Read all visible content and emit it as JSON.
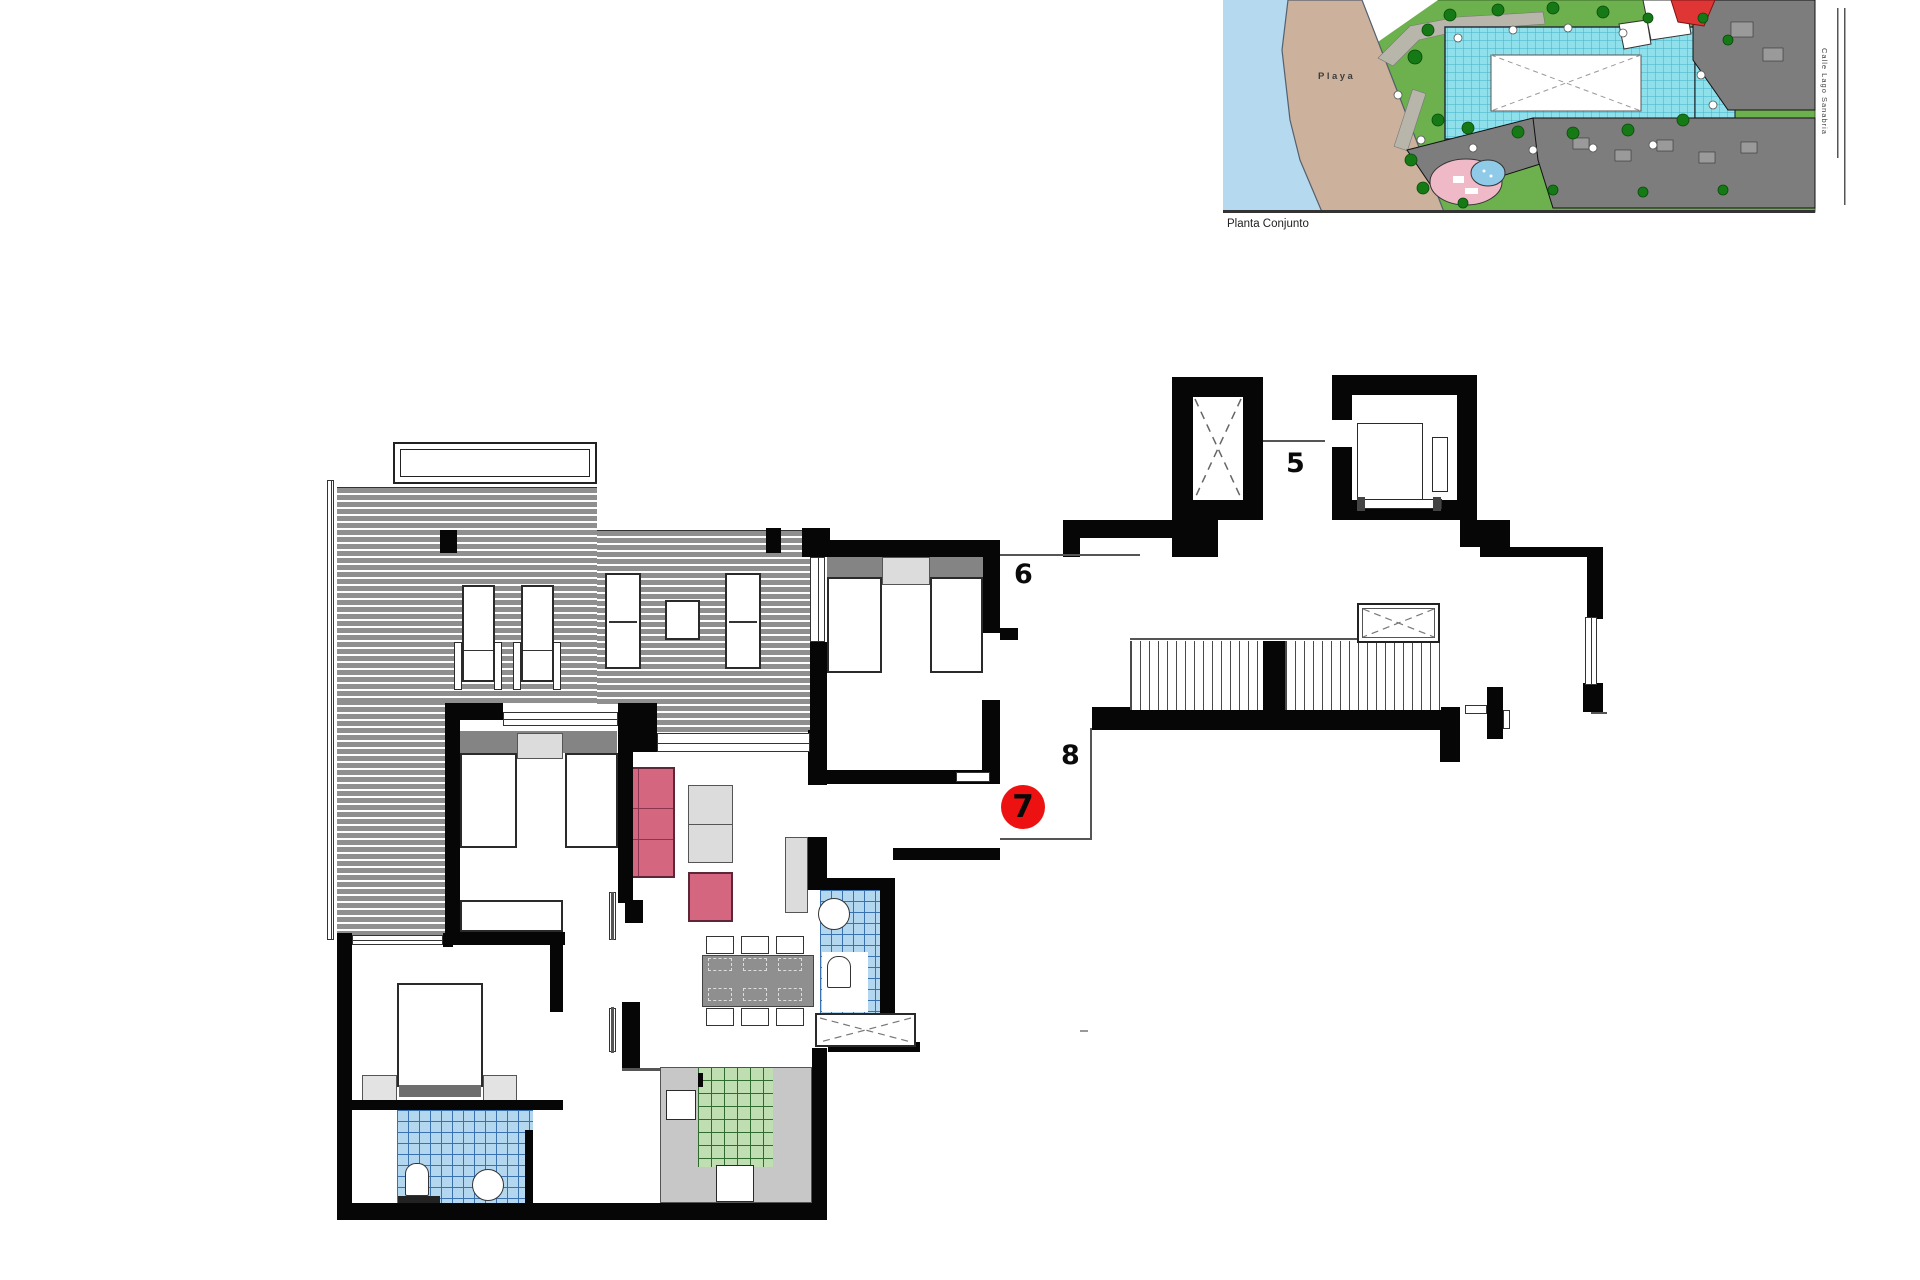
{
  "document": {
    "caption_site_plan": "Planta Conjunto"
  },
  "site_plan": {
    "beach_label": "Playa",
    "street_label": "Calle Lago Sanabria",
    "colors": {
      "water": "#b5daf0",
      "sand": "#ccb29c",
      "lawn": "#6cb14d",
      "pool": "#8fe0ea",
      "tree": "#157a15",
      "building": "#7d7d7d",
      "highlighted_building": "#e03535",
      "pond_pink": "#f0b9c8",
      "pond_blue": "#8fcbe8"
    }
  },
  "floor_plan": {
    "labels": {
      "unit_5": "5",
      "unit_6": "6",
      "unit_8": "8"
    },
    "highlighted_unit": {
      "number": "7",
      "marker_color": "#ee1111"
    },
    "colors": {
      "wall": "#060606",
      "terrace_deck": "#8f8f8f",
      "bathroom_tile": "#b3d7ee",
      "kitchen_tile": "#bfdfb2",
      "sofa": "#d4677f",
      "furniture_gray": "#dcdcdc",
      "counter_gray": "#c7c7c7"
    }
  }
}
